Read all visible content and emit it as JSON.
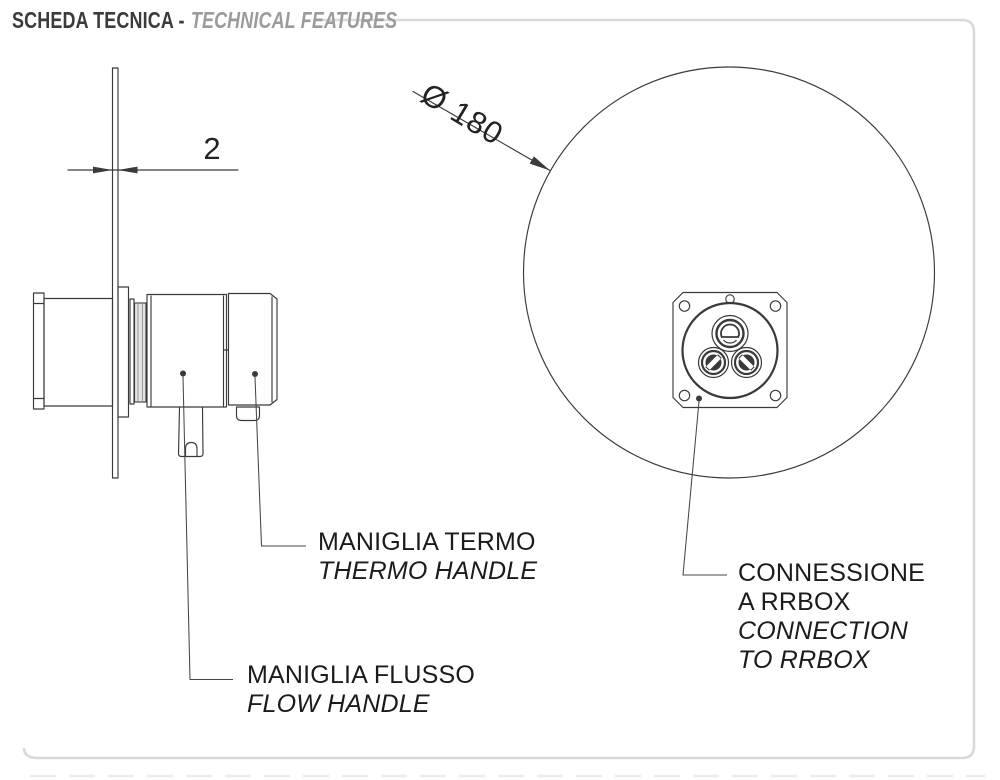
{
  "header": {
    "title_it": "SCHEDA TECNICA -",
    "title_en": "TECHNICAL FEATURES"
  },
  "side_view": {
    "dimension_plate_thickness": "2",
    "thermo_label_it": "MANIGLIA TERMO",
    "thermo_label_en": "THERMO HANDLE",
    "flow_label_it": "MANIGLIA FLUSSO",
    "flow_label_en": "FLOW HANDLE"
  },
  "front_view": {
    "dimension_diameter": "Ø 180",
    "rrbox_label_it_1": "CONNESSIONE",
    "rrbox_label_it_2": "A RRBOX",
    "rrbox_label_en_1": "CONNECTION",
    "rrbox_label_en_2": "TO RRBOX"
  },
  "colors": {
    "frame": "#d9d9d9",
    "drawing_line": "#3a3a3a",
    "title_dark": "#3b3b3b",
    "title_gray": "#9b9b9b",
    "label_text": "#1b1b1b"
  }
}
